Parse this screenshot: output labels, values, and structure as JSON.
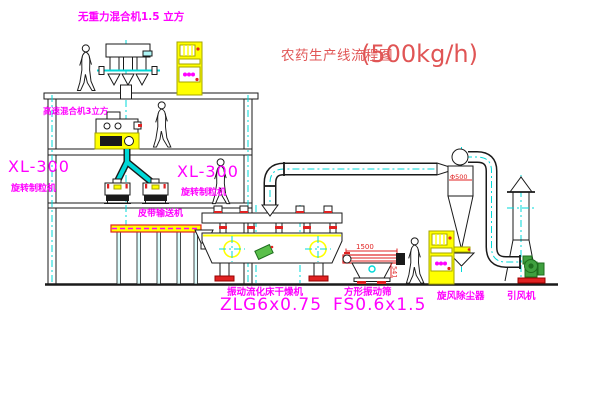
{
  "title": {
    "name_cn": "农药生产线流程图",
    "capacity": "(500kg/h)"
  },
  "labels": {
    "top_mixer": "无重力混合机1.5 立方",
    "high_speed_mixer": "高速混合机3立方",
    "granulator_left_model": "XL-300",
    "granulator_left_name": "旋转制粒机",
    "granulator_center_model": "XL-300",
    "granulator_center_name": "旋转制粒机",
    "belt_conveyor": "皮带输送机",
    "fluid_bed_dryer_name": "振动流化床干燥机",
    "fluid_bed_dryer_model": "ZLG6x0.75",
    "square_sieve_name": "方形振动筛",
    "square_sieve_model": "FS0.6x1.5",
    "cyclone_dust_collector": "旋风除尘器",
    "induced_draft_fan": "引风机"
  },
  "dimensions": {
    "sieve_length": "1500",
    "sieve_height": "541",
    "cyclone_diameter": "Φ500"
  },
  "colors": {
    "background": "#FFFFFF",
    "line": "#1A1A1A",
    "magenta": "#FF00FF",
    "title_red": "#E05555",
    "accent_red": "#E02222",
    "cyan": "#00D8D8",
    "yellow": "#FFFF00",
    "green": "#3FA03F"
  }
}
